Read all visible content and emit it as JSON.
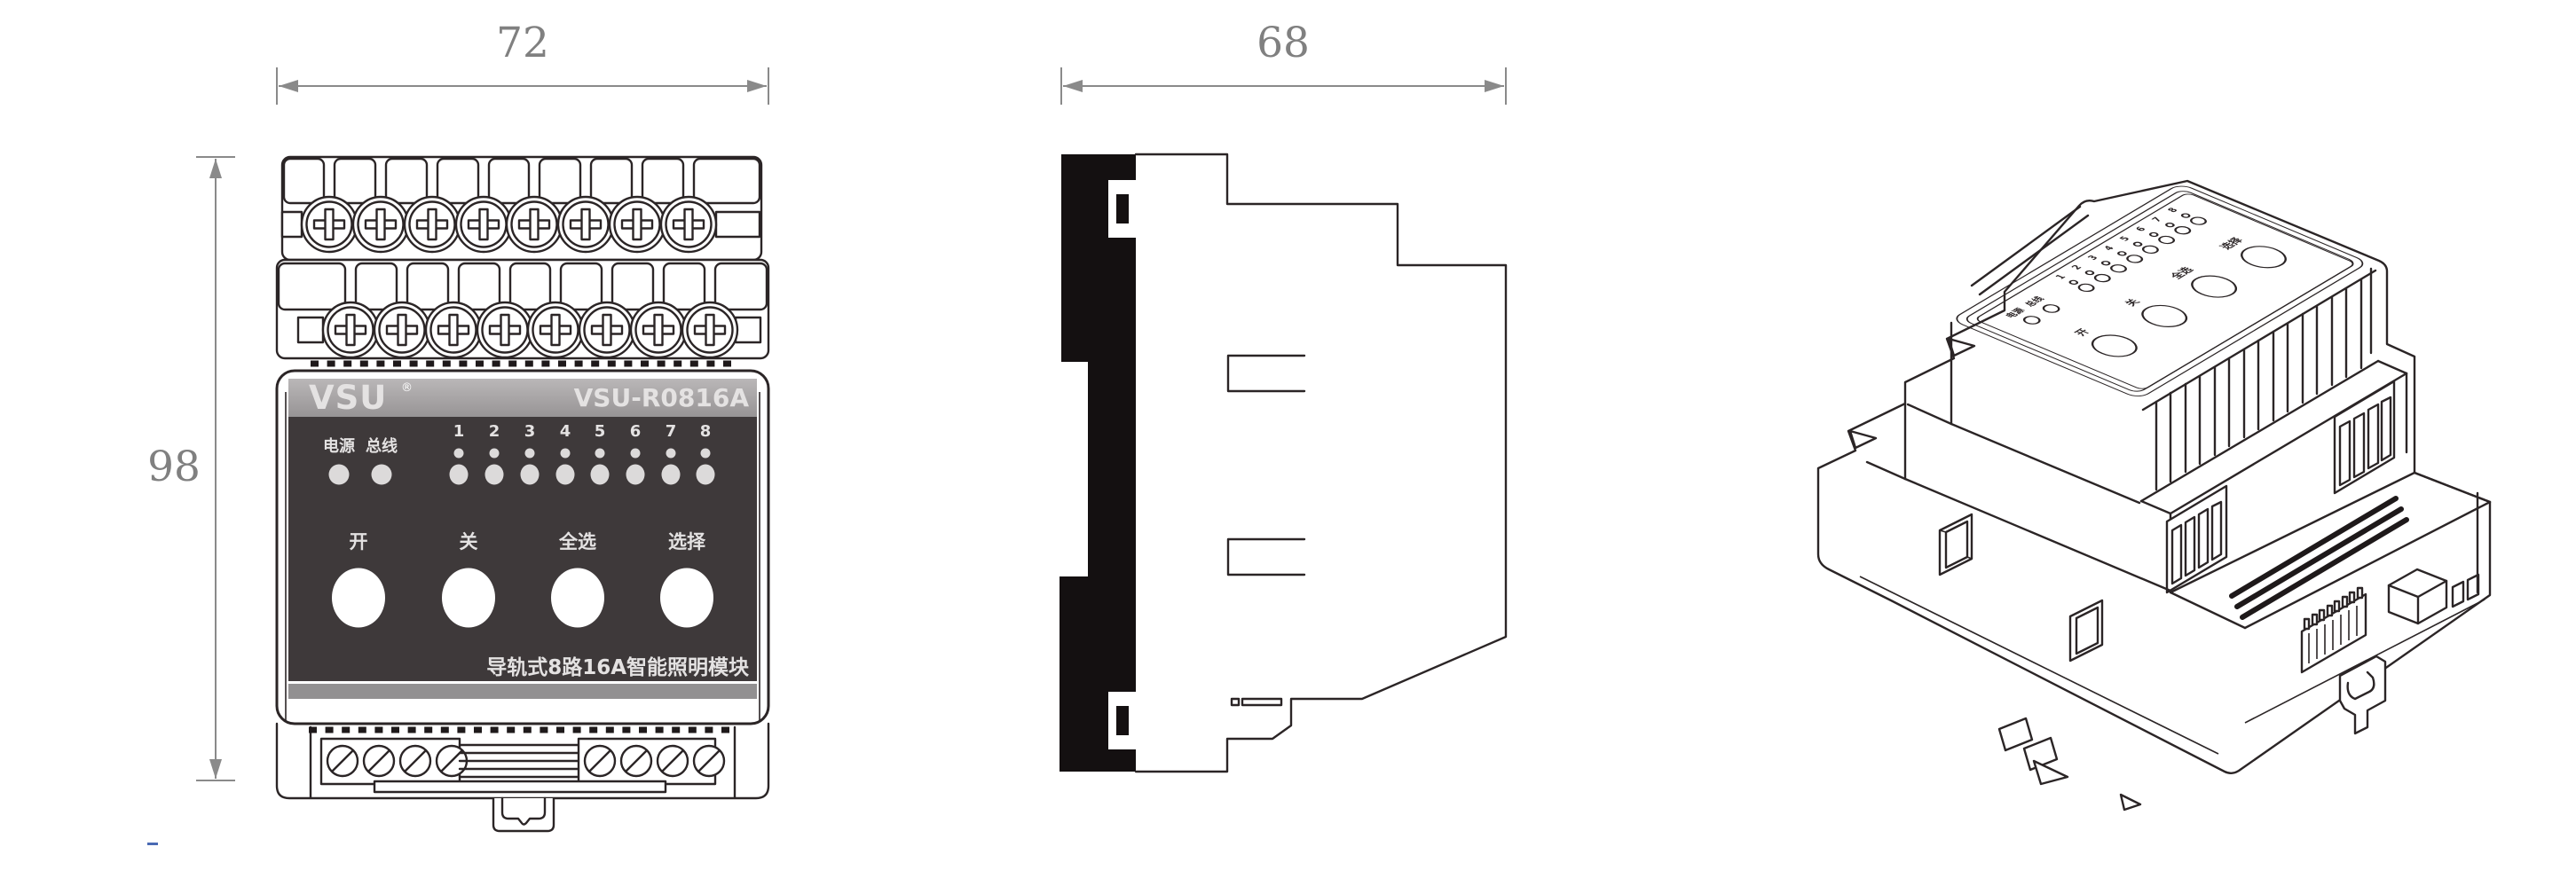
{
  "drawing": {
    "title": "VSU-R0816A rail-mounted lighting module dimension drawing",
    "front_view": {
      "width_dim": "72",
      "height_dim": "98",
      "brand": "VSU",
      "brand_reg": "®",
      "model": "VSU-R0816A",
      "power_led_label": "电源",
      "bus_led_label": "总线",
      "channel_numbers": [
        "1",
        "2",
        "3",
        "4",
        "5",
        "6",
        "7",
        "8"
      ],
      "button_labels": [
        "开",
        "关",
        "全选",
        "选择"
      ],
      "caption": "导轨式8路16A智能照明模块"
    },
    "side_view": {
      "depth_dim": "68"
    }
  },
  "colors": {
    "line": "#2B2526",
    "side_fill_black": "#141011",
    "panel_dark": "#3E393A",
    "header_gray_top": "#BAB7B8",
    "header_gray_bottom": "#979495",
    "led_gray": "#DCDADA",
    "bottom_strip_gray": "#929091",
    "dimension_gray": "#8A8A8A",
    "artifact_blue": "#4A6AB4"
  }
}
